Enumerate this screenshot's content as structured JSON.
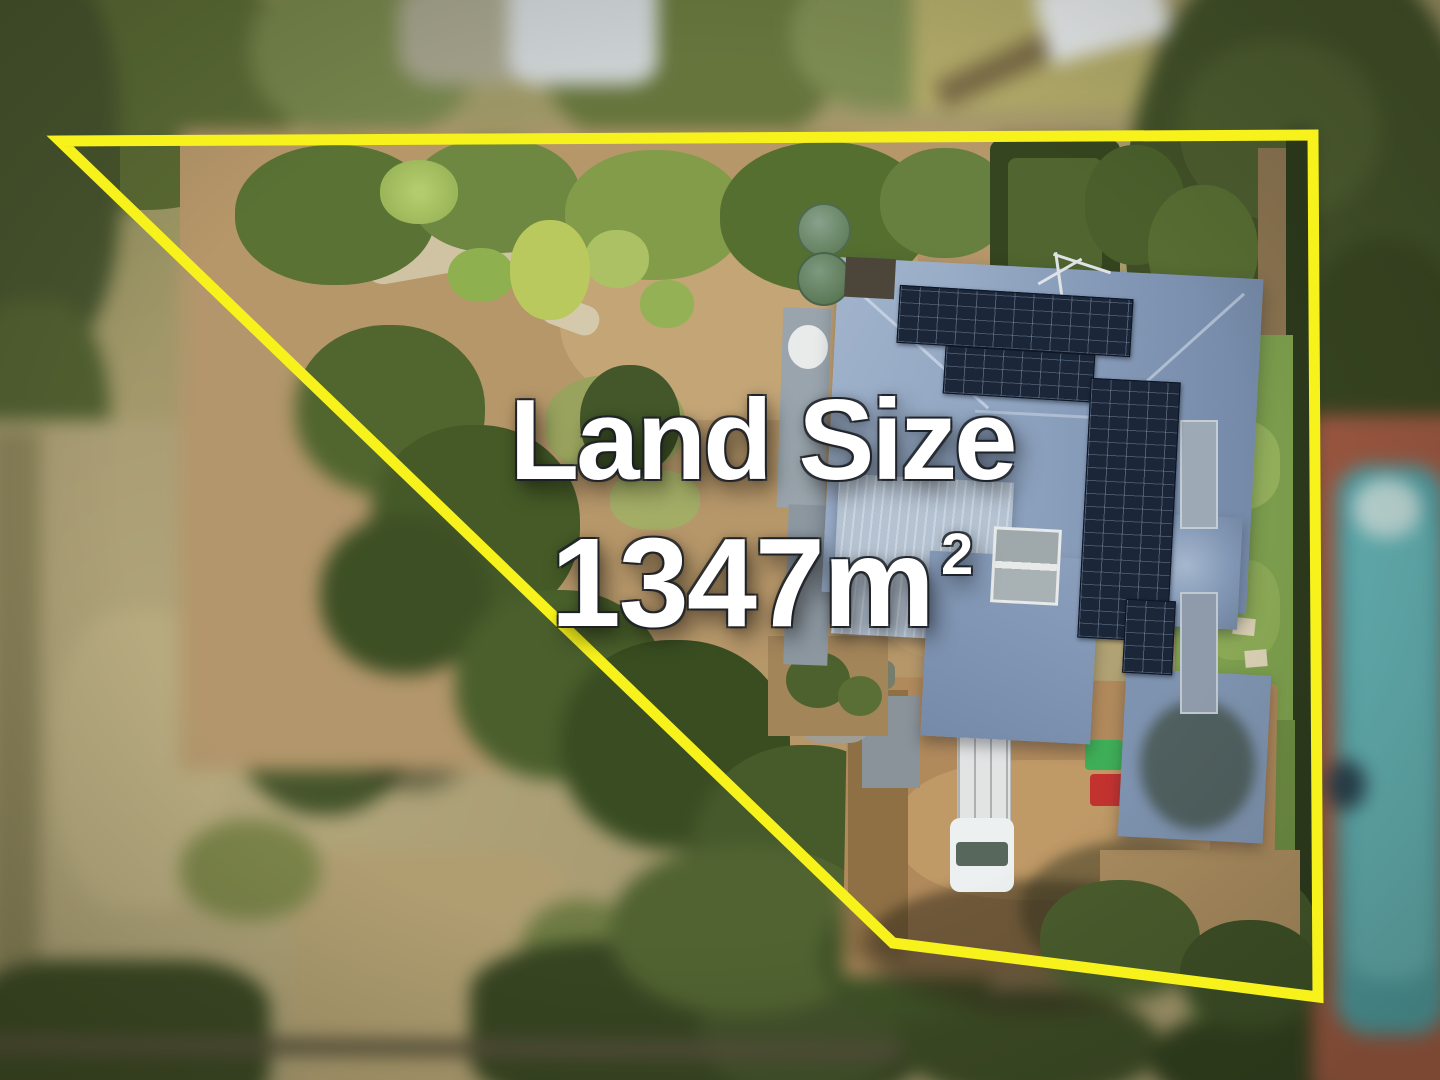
{
  "image": {
    "kind": "real-estate aerial drone photograph",
    "subject": "residential property with blue-grey hip roof, solar panels, gardens and driveway; surroundings blurred outside the lot boundary"
  },
  "overlay": {
    "line1": "Land Size",
    "line2_value": "1347m",
    "line2_superscript": "2",
    "text_color": "#ffffff",
    "outline_color": "#1c1f26"
  },
  "boundary": {
    "color": "#f7f21c",
    "stroke_width": "11",
    "points": "60,141 1313,135 1318,997 893,943"
  },
  "palette": {
    "roof_blue": "#8ea3c0",
    "solar_panel": "#1b2638",
    "dirt": "#b6976a",
    "lawn": "#7c9e4d",
    "tree_dark": "#3d5023",
    "pool_teal": "#4c9da3",
    "pool_paving": "#a05740",
    "meadow": "#ab9e72"
  }
}
